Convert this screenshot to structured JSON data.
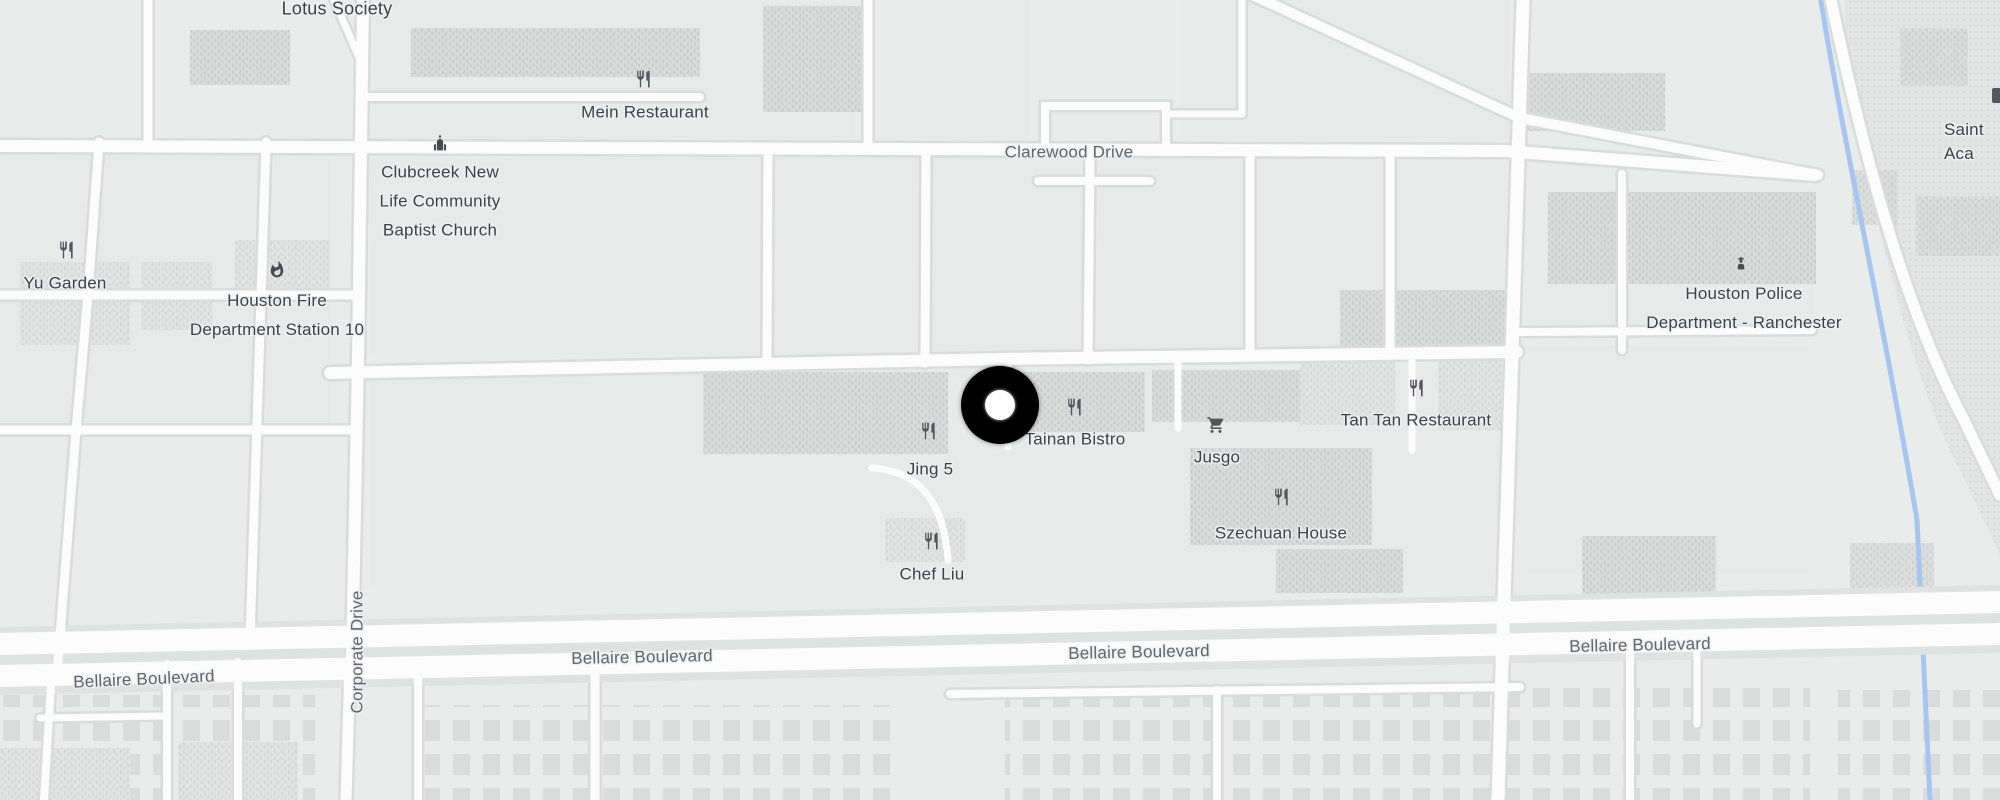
{
  "map_type": "street-map",
  "area": "Houston Bellaire / Chinatown district",
  "colors": {
    "background": "#eaeceb",
    "road": "#fbfcfb",
    "road_casing": "#d9dcdb",
    "building_hatch": "#d8dbda",
    "bayou_blue": "#a6c6f1",
    "poi_label": "#3e4246",
    "street_label": "#62666a",
    "icon": "#54575a",
    "marker": "#000000",
    "marker_inner": "#ffffff"
  },
  "marker": {
    "x": 1000,
    "y": 405,
    "outer_d": 78,
    "inner_d": 30
  },
  "pois": [
    {
      "id": "lotus-society",
      "label": "Lotus Society",
      "x": 337,
      "y": 9
    },
    {
      "id": "mein-restaurant",
      "label": "Mein Restaurant",
      "x": 645,
      "y": 112,
      "icon": "restaurant-icon",
      "ix": 643,
      "iy": 79
    },
    {
      "id": "clubcreek-baptist-church",
      "label": "Clubcreek New\nLife Community\nBaptist Church",
      "x": 440,
      "y": 201,
      "icon": "church-icon",
      "ix": 440,
      "iy": 143
    },
    {
      "id": "yu-garden",
      "label": "Yu Garden",
      "x": 65,
      "y": 283,
      "icon": "restaurant-icon",
      "ix": 66,
      "iy": 250
    },
    {
      "id": "houston-fire-station-10",
      "label": "Houston Fire\nDepartment Station 10",
      "x": 277,
      "y": 315,
      "icon": "fire-icon",
      "ix": 277,
      "iy": 270
    },
    {
      "id": "houston-police-ranchester",
      "label": "Houston Police\nDepartment - Ranchester",
      "x": 1744,
      "y": 308,
      "icon": "police-icon",
      "ix": 1741,
      "iy": 263
    },
    {
      "id": "tainan-bistro",
      "label": "Tainan Bistro",
      "x": 1075,
      "y": 439,
      "icon": "restaurant-icon",
      "ix": 1074,
      "iy": 407
    },
    {
      "id": "jing-5",
      "label": "Jing 5",
      "x": 930,
      "y": 469,
      "icon": "restaurant-icon",
      "ix": 928,
      "iy": 431
    },
    {
      "id": "jusgo",
      "label": "Jusgo",
      "x": 1217,
      "y": 457,
      "icon": "cart-icon",
      "ix": 1216,
      "iy": 425
    },
    {
      "id": "tan-tan-restaurant",
      "label": "Tan Tan Restaurant",
      "x": 1416,
      "y": 420,
      "icon": "restaurant-icon",
      "ix": 1416,
      "iy": 388
    },
    {
      "id": "szechuan-house",
      "label": "Szechuan House",
      "x": 1281,
      "y": 533,
      "icon": "restaurant-icon",
      "ix": 1281,
      "iy": 497
    },
    {
      "id": "chef-liu",
      "label": "Chef Liu",
      "x": 932,
      "y": 574,
      "icon": "restaurant-icon",
      "ix": 931,
      "iy": 541
    },
    {
      "id": "saint-academy-clipped",
      "label": "Saint\nAca",
      "x": 1944,
      "y": 142
    }
  ],
  "streets": [
    {
      "id": "clarewood-drive",
      "label": "Clarewood Drive",
      "x": 1069,
      "y": 152
    },
    {
      "id": "corporate-drive",
      "label": "Corporate Drive",
      "x": 357,
      "y": 652
    },
    {
      "id": "bellaire-blvd-west",
      "label": "Bellaire Boulevard",
      "x": 144,
      "y": 679
    },
    {
      "id": "bellaire-blvd-cw",
      "label": "Bellaire Boulevard",
      "x": 642,
      "y": 657
    },
    {
      "id": "bellaire-blvd-c",
      "label": "Bellaire Boulevard",
      "x": 1139,
      "y": 652
    },
    {
      "id": "bellaire-blvd-east",
      "label": "Bellaire Boulevard",
      "x": 1640,
      "y": 645
    }
  ]
}
